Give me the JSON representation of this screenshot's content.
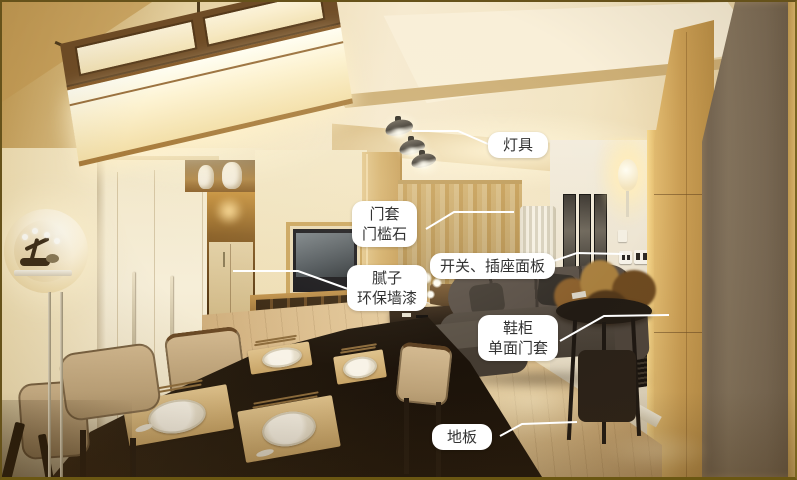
{
  "colors": {
    "label_background": "#ffffff",
    "label_text": "#333333",
    "leader_line": "#ffffff",
    "photo_border": "#66521a"
  },
  "annotations": [
    {
      "name": "lighting",
      "lines": [
        "灯具"
      ],
      "target": "ceiling-spotlights"
    },
    {
      "name": "door-casing",
      "lines": [
        "门套",
        "门槛石"
      ],
      "target": "balcony-doorway"
    },
    {
      "name": "switch-socket-panel",
      "lines": [
        "开关、插座面板"
      ],
      "target": "wall-switch-panels"
    },
    {
      "name": "putty-wall-paint",
      "lines": [
        "腻子",
        "环保墙漆"
      ],
      "target": "painted-wall"
    },
    {
      "name": "shoe-cabinet",
      "lines": [
        "鞋柜",
        "单面门套"
      ],
      "target": "entry-door-area"
    },
    {
      "name": "wood-floor",
      "lines": [
        "地板"
      ],
      "target": "wood-floor"
    }
  ]
}
